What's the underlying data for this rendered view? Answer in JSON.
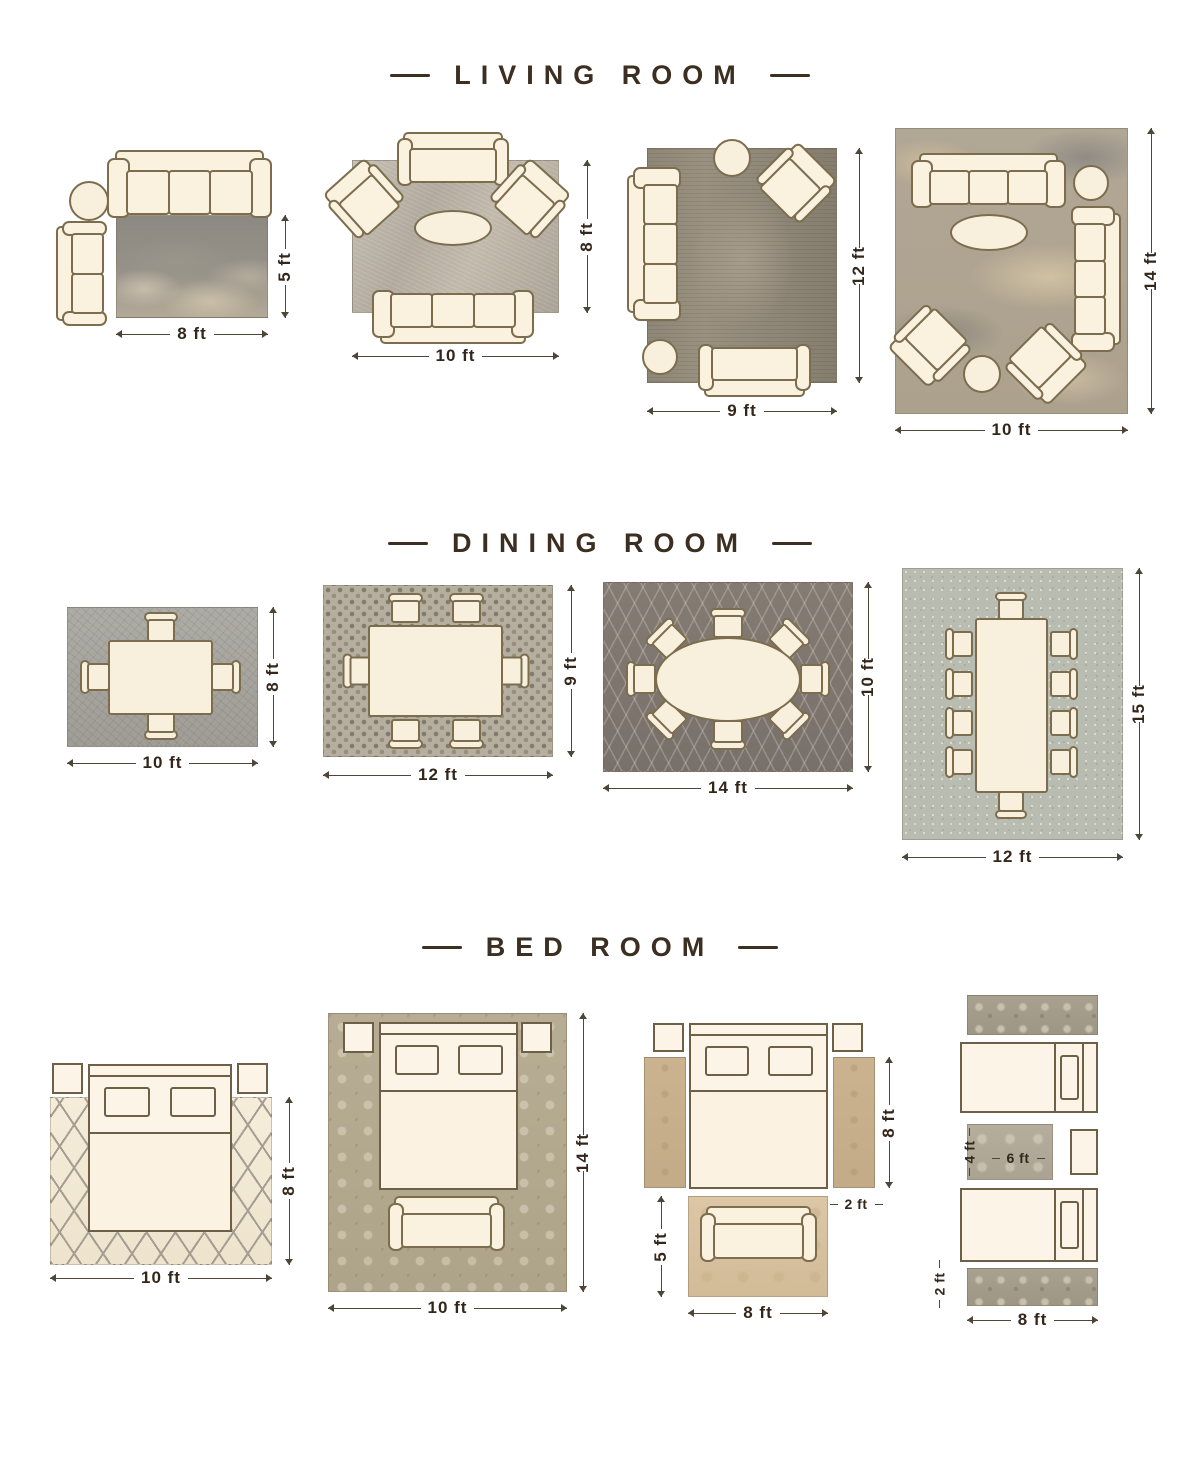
{
  "page": {
    "background": "#ffffff"
  },
  "colors": {
    "title_text": "#3c2e21",
    "dimension_text": "#33261a",
    "furniture_fill": "#faf1df",
    "furniture_outline": "#7c6d4f"
  },
  "sections": {
    "living": {
      "title": "LIVING ROOM",
      "layouts": {
        "l1": {
          "w": "8 ft",
          "h": "5 ft"
        },
        "l2": {
          "w": "10 ft",
          "h": "8 ft"
        },
        "l3": {
          "w": "9 ft",
          "h": "12 ft"
        },
        "l4": {
          "w": "10 ft",
          "h": "14 ft"
        }
      }
    },
    "dining": {
      "title": "DINING ROOM",
      "layouts": {
        "d1": {
          "w": "10 ft",
          "h": "8 ft"
        },
        "d2": {
          "w": "12 ft",
          "h": "9 ft"
        },
        "d3": {
          "w": "14 ft",
          "h": "10 ft"
        },
        "d4": {
          "w": "12 ft",
          "h": "15 ft"
        }
      }
    },
    "bedroom": {
      "title": "BED ROOM",
      "layouts": {
        "b1": {
          "w": "10 ft",
          "h": "8 ft"
        },
        "b2": {
          "w": "10 ft",
          "h": "14 ft"
        },
        "b3": {
          "w": "8 ft",
          "h": "5 ft",
          "runner_h": "8 ft",
          "runner_w": "2 ft"
        },
        "b4": {
          "w": "8 ft",
          "runner_w": "2 ft",
          "accent_w": "6 ft",
          "accent_h": "4 ft"
        }
      }
    }
  }
}
